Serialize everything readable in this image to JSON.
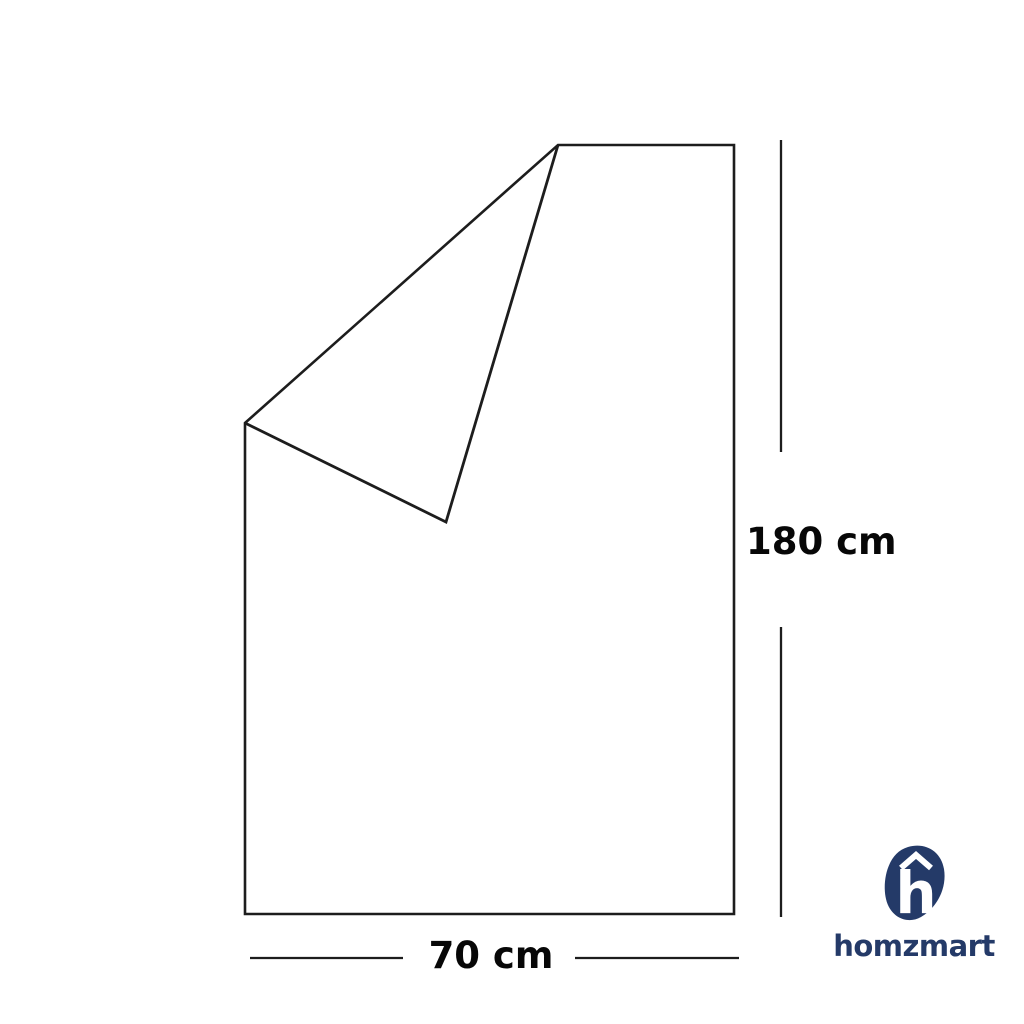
{
  "diagram": {
    "height_label": "180 cm",
    "width_label": "70 cm",
    "line_color": "#1d1d1d",
    "label_color": "#070707"
  },
  "logo": {
    "wordmark": "homzmart",
    "icon_letter": "h",
    "icon_name": "h-roof-blob-icon",
    "navy": "#243a68",
    "white": "#ffffff"
  }
}
